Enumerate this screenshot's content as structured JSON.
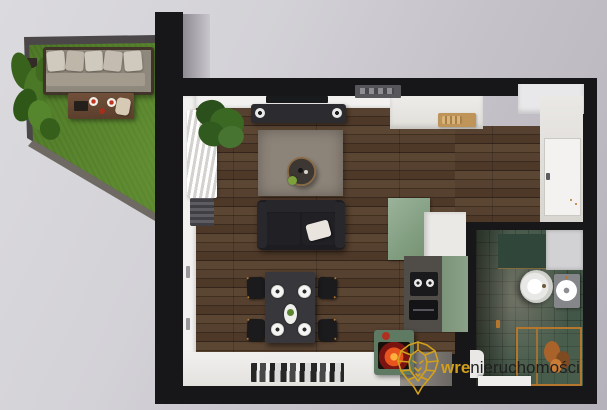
{
  "scene": {
    "type": "3d-apartment-floor-plan-render",
    "areas": [
      "garden-terrace",
      "living-room",
      "dining-area",
      "kitchen",
      "entry",
      "bathroom"
    ]
  },
  "watermark": {
    "logo_icon": "lion-diamond-icon",
    "brand_prefix": "wre",
    "brand_suffix": "nieruchomości"
  },
  "palette": {
    "accent_gold": "#d2a01c",
    "wall_black": "#17171a",
    "grass_green": "#4e7827",
    "wood_floor": "#4a3629",
    "kitchen_sage": "#84a083",
    "bathroom_green": "#435748",
    "inner_wall_white": "#f2f1ef",
    "background_gray": "#cdcad2",
    "watermark_text_dark": "#202020"
  }
}
